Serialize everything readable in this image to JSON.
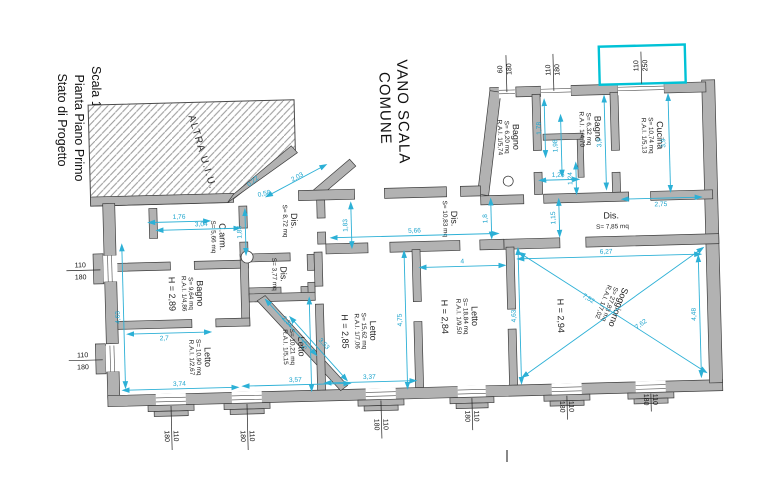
{
  "title_block": {
    "line1": "Stato di Progetto",
    "line2": "Pianta Piano Primo",
    "line3": "Scala 1:100"
  },
  "labels": {
    "stairwell_line1": "VANO SCALA",
    "stairwell_line2": "COMUNE",
    "other_unit": "ALTRA U.I.U."
  },
  "rooms": {
    "dis1": {
      "name": "Dis.",
      "area": "S= 8,72 mq"
    },
    "cam": {
      "name": "C.arm.",
      "area": "S= 5,66 mq"
    },
    "bagno1": {
      "name": "Bagno",
      "area": "S= 9,64 mq",
      "rai": "R.A.I. 1/4,86",
      "height": "H = 2,89"
    },
    "dis2": {
      "name": "Dis.",
      "area": "S= 3,77 mq"
    },
    "letto1": {
      "name": "Letto",
      "area": "S= 10,90 mq",
      "rai": "R.A.I. 1/2,67"
    },
    "letto2": {
      "name": "Letto",
      "area": "S= 10,21 mq",
      "rai": "R.A.I. 1/5,15"
    },
    "letto3": {
      "name": "Letto",
      "area": "S= 15,62 mq",
      "rai": "R.A.I. 1/7,06",
      "height": "H = 2,85"
    },
    "dis3": {
      "name": "Dis.",
      "area": "S= 10,83 mq"
    },
    "letto4": {
      "name": "Letto",
      "area": "S= 18,84 mq",
      "rai": "R.A.I. 1/9,50",
      "height": "H = 2,84"
    },
    "soggiorno": {
      "name": "Soggiorno",
      "area": "S= 27,83 mq",
      "rai": "R.A.I. 1/7,02",
      "height": "H = 2,94"
    },
    "dis4": {
      "name": "Dis.",
      "area": "S= 7,85 mq"
    },
    "bagno2": {
      "name": "Bagno",
      "area": "S= 6,20 mq",
      "rai": "R.A.I. 1/5,74"
    },
    "bagno3": {
      "name": "Bagno",
      "area": "S= 6,32 mq",
      "rai": "R.A.I. 1/4,70"
    },
    "cucina": {
      "name": "Cucina",
      "area": "S= 10,74 mq",
      "rai": "R.A.I. 1/5,13"
    }
  },
  "windows": {
    "small": {
      "w": "60",
      "h": "180"
    },
    "standard": {
      "w": "110",
      "h": "180"
    },
    "tall": {
      "w": "110",
      "h": "250"
    }
  },
  "dims": {
    "d176": "1,76",
    "d304": "3,04",
    "d183": "1,83",
    "d022": "0,22",
    "d058": "0,58",
    "d203": "2,03",
    "d463": "4,63",
    "d27": "2,7",
    "d374": "3,74",
    "d234": "2,34",
    "d353": "3,53",
    "d357": "3,57",
    "d32": "3,2",
    "d337": "3,37",
    "d475": "4,75",
    "d4": "4",
    "d627": "6,27",
    "d448": "4,48",
    "d762": "7,62",
    "d752": "7,52",
    "d566": "5,66",
    "d18": "1,8",
    "d115": "1,15",
    "d124": "1,24",
    "d275": "2,75",
    "d126": "1,26",
    "d178": "1,78",
    "d198": "1,98",
    "d39": "3,9"
  },
  "colors": {
    "dimension_lines": "#2cb0d6",
    "balcony": "#00c2d6",
    "wall_fill": "#b2b2b2",
    "wall_stroke": "#3d3d3d",
    "text": "#1d1d1d"
  }
}
